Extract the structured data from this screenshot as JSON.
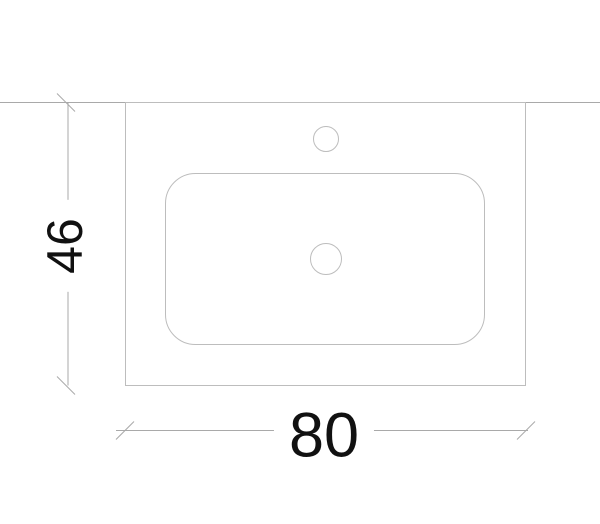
{
  "drawing": {
    "type": "technical-dimension-drawing",
    "subject": "washbasin-countertop-top-view",
    "width_dimension": {
      "label": "80"
    },
    "height_dimension": {
      "label": "46"
    },
    "colors": {
      "outline": "#bdbdbd",
      "dimension_line": "#a9a9a9",
      "label_text": "#111111",
      "background": "#ffffff"
    }
  }
}
